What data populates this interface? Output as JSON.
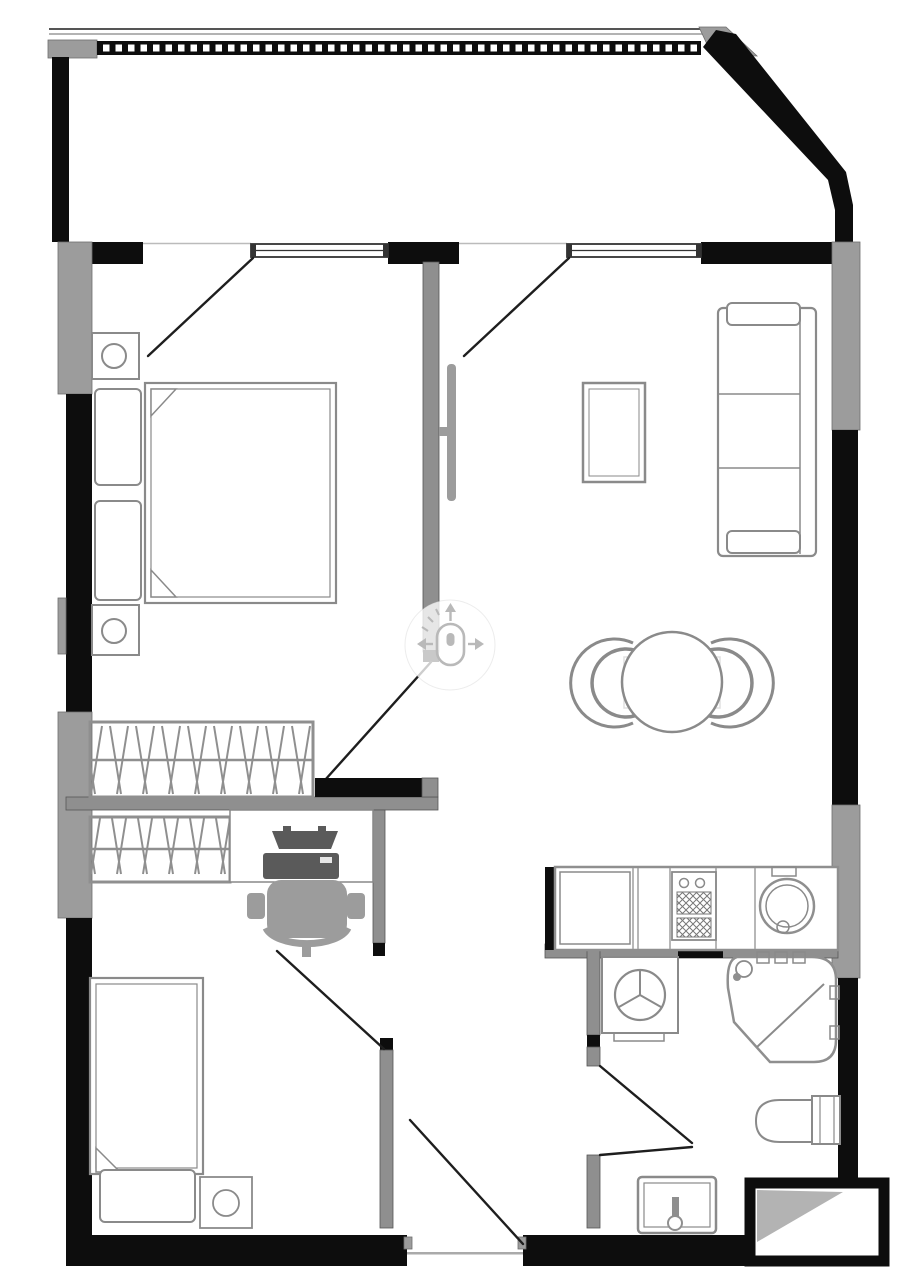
{
  "meta": {
    "aria_label": "Apartment floor plan, top-down architectural drawing",
    "drawing_type": "floor plan"
  },
  "colors": {
    "wall": "#0d0d0d",
    "glazing": "#9c9c9c",
    "interior-wall": "#8f8f8f",
    "furniture-line": "#8a8a8a",
    "fixture-line": "#9a9a9a",
    "dark-accessory": "#5a5a5a",
    "overlay-icon": "#b9b9b9",
    "background": "#ffffff"
  },
  "overlay": {
    "icon": "pan-mouse-icon",
    "label": "Drag or scroll to pan the plan"
  },
  "rooms": {
    "balcony": {
      "label": "balcony",
      "features": [
        "dashed-railing",
        "angled-wall"
      ]
    },
    "bedroom": {
      "label": "bedroom",
      "furniture": [
        "double-bed",
        "pillow",
        "pillow",
        "nightstand-with-lamp",
        "nightstand-with-lamp",
        "wardrobe-hangers",
        "balcony-door",
        "wall-tv"
      ]
    },
    "living_room": {
      "label": "living-room",
      "furniture": [
        "three-seat-sofa",
        "coffee-table",
        "round-dining-table",
        "dining-chair",
        "dining-chair",
        "balcony-door"
      ]
    },
    "study_hall": {
      "label": "study-hall",
      "furniture": [
        "wardrobe-hangers",
        "desk",
        "laptop",
        "office-chair"
      ]
    },
    "second_bedroom": {
      "label": "second-bedroom",
      "furniture": [
        "single-bed",
        "pillow",
        "nightstand-with-lamp"
      ]
    },
    "kitchen": {
      "label": "kitchen",
      "furniture": [
        "counter-cabinet",
        "stove-hob",
        "round-sink",
        "tap"
      ]
    },
    "bathroom": {
      "label": "bathroom",
      "furniture": [
        "washing-machine",
        "corner-bathtub",
        "bath-faucet",
        "toilet",
        "washbasin"
      ]
    },
    "entry": {
      "label": "entry-hall",
      "features": [
        "front-door",
        "threshold"
      ]
    }
  }
}
